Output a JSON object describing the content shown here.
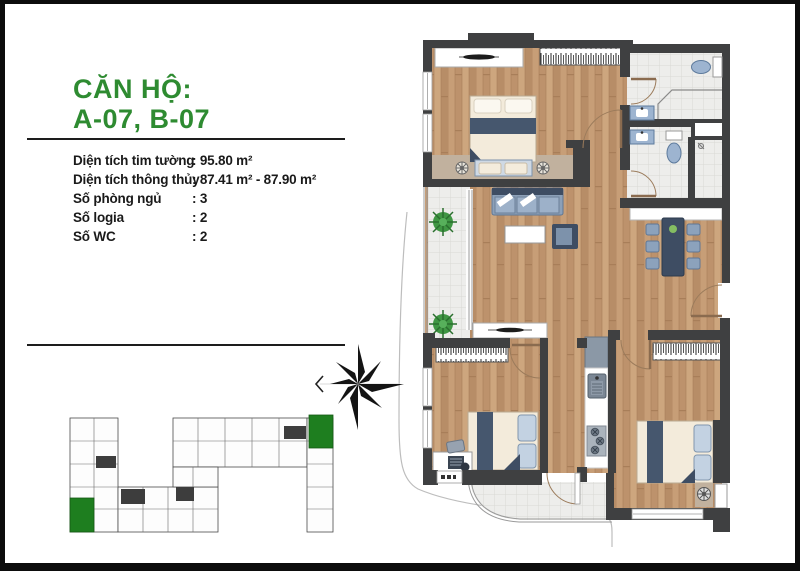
{
  "header": {
    "title_line1": "CĂN HỘ:",
    "title_line2": "A-07, B-07"
  },
  "specs": {
    "rows": [
      {
        "label": "Diện tích tim tường",
        "value": ": 95.80 m²"
      },
      {
        "label": "Diện tích thông thủy",
        "value": ": 87.41 m² - 87.90 m²"
      },
      {
        "label": "Số phòng ngủ",
        "value": ": 3"
      },
      {
        "label": "Số logia",
        "value": ": 2"
      },
      {
        "label": "Số WC",
        "value": ": 2"
      }
    ]
  },
  "keyplan": {
    "highlighted_unit_count": 2,
    "highlight_color": "#1e7e1f"
  },
  "compass": {
    "icon": "north-star-compass",
    "pointer": "west-chevron"
  },
  "colors": {
    "accent_green": "#2e8b31",
    "wall": "#3f4041",
    "wood_floor": "#c49a74",
    "tile_floor": "#ededeb",
    "furniture_navy": "#3e4d63",
    "furniture_blue": "#8ca0b8",
    "bedding_cream": "#f3ebdb",
    "fixture_blue": "#9db4d0",
    "plant_green": "#3f9643",
    "frame_black": "#0c0c0c"
  }
}
